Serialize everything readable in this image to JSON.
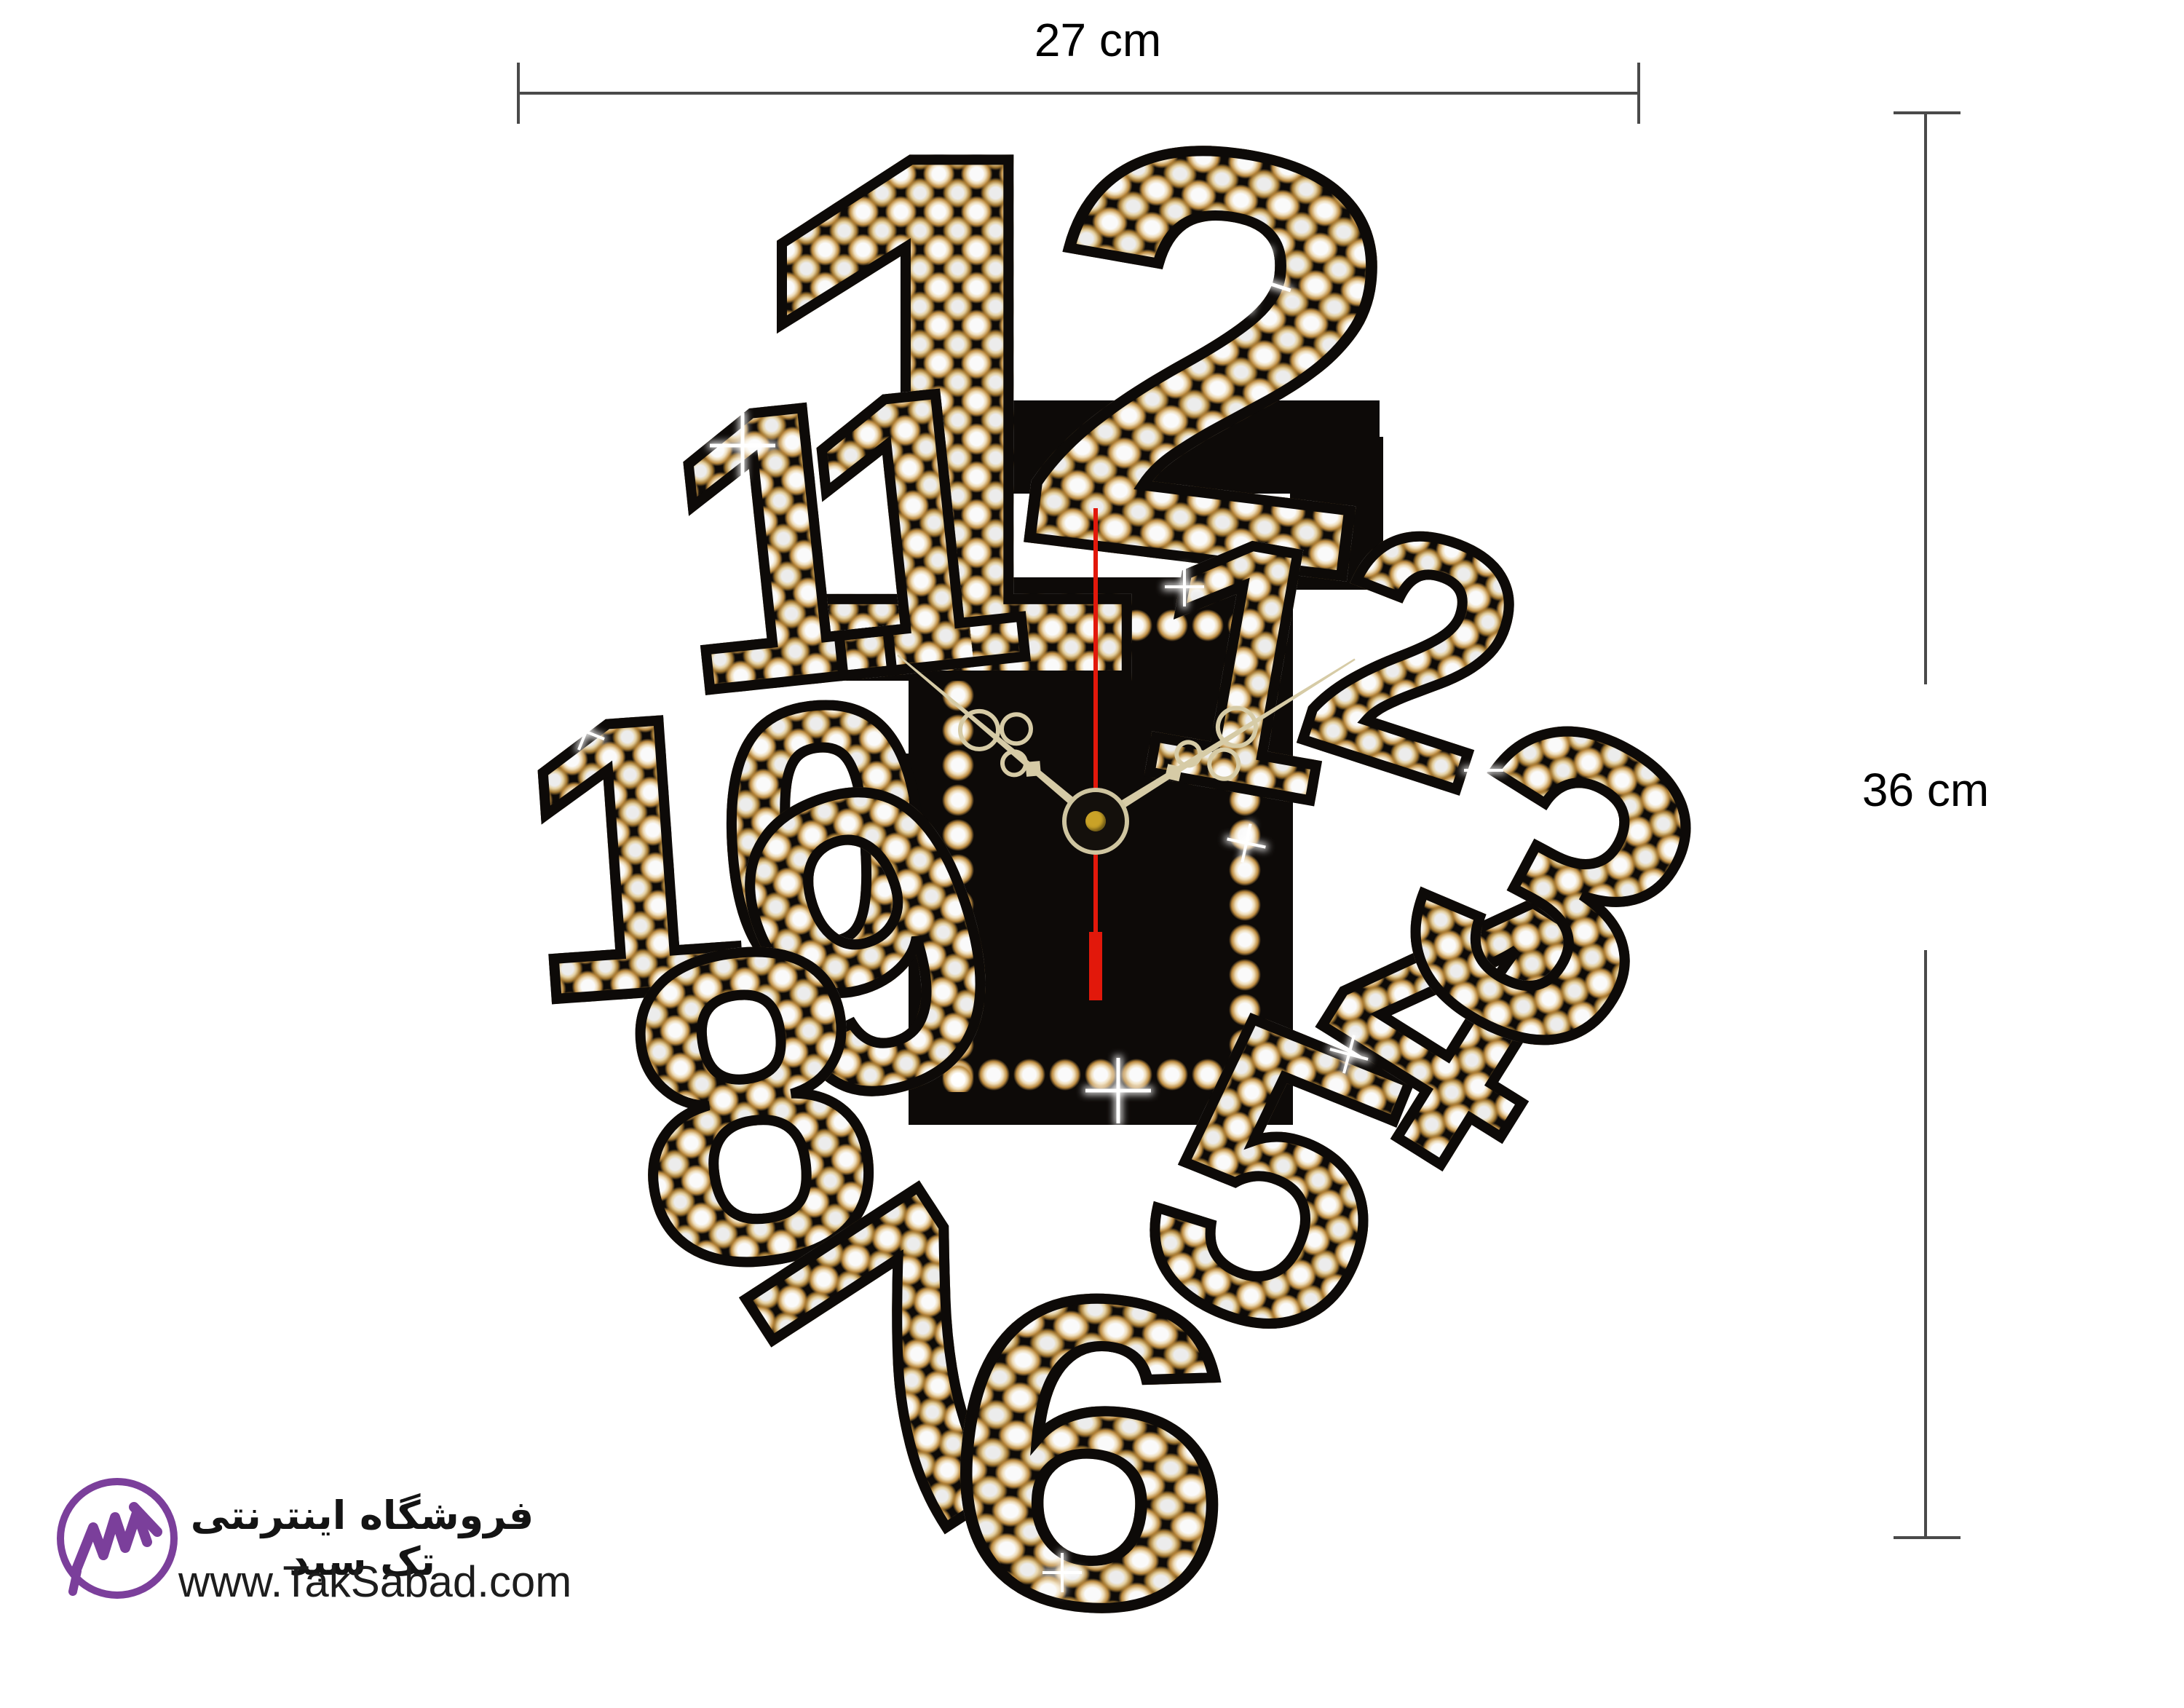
{
  "annotations": {
    "width_label": "27 cm",
    "height_label": "36 cm"
  },
  "clock": {
    "numerals": [
      {
        "id": "twelve-digit-1",
        "label": "1"
      },
      {
        "id": "twelve-digit-2",
        "label": "2"
      },
      {
        "id": "eleven",
        "label": "11"
      },
      {
        "id": "ten",
        "label": "10"
      },
      {
        "id": "nine",
        "label": "9"
      },
      {
        "id": "eight",
        "label": "8"
      },
      {
        "id": "seven",
        "label": "7"
      },
      {
        "id": "six",
        "label": "6"
      },
      {
        "id": "five",
        "label": "5"
      },
      {
        "id": "four",
        "label": "4"
      },
      {
        "id": "three",
        "label": "3"
      },
      {
        "id": "two",
        "label": "2"
      },
      {
        "id": "one",
        "label": "1"
      }
    ],
    "colors": {
      "body": "#0d0a08",
      "hands": "#d6cba6",
      "second_hand": "#e2180b",
      "pivot_gold": "#c9a227"
    }
  },
  "watermark": {
    "store_name_fa": "فروشگاه اینترنتی تک سبد",
    "website": "www.TakSabad.com",
    "logo_color": "#7b3f9b"
  }
}
